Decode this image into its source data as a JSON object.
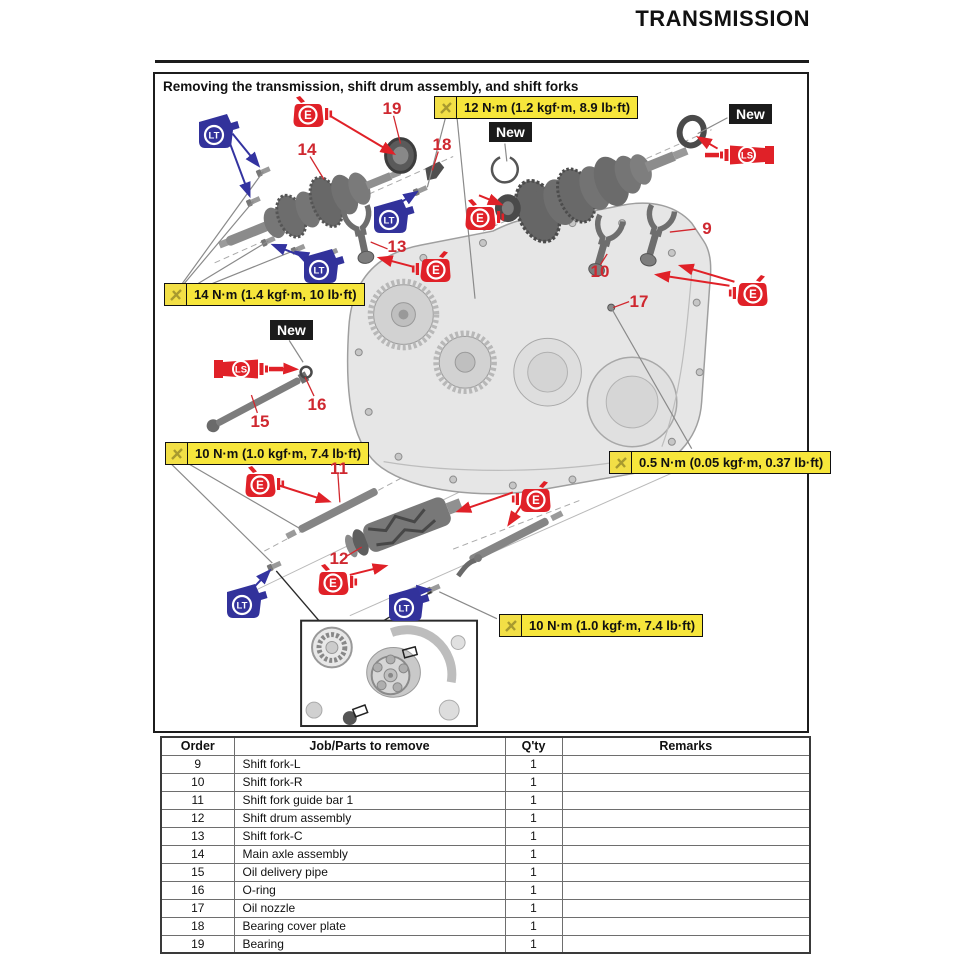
{
  "page": {
    "header_title": "TRANSMISSION"
  },
  "figure": {
    "title": "Removing the transmission, shift drum assembly, and shift forks",
    "new_label": "New",
    "callouts": [
      {
        "name": "torque-bearing-plate",
        "text": "12 N·m (1.2 kgf·m, 8.9 lb·ft)"
      },
      {
        "name": "torque-main-axle-bolts",
        "text": "14 N·m (1.4 kgf·m, 10 lb·ft)"
      },
      {
        "name": "torque-guide-bar",
        "text": "10 N·m (1.0 kgf·m, 7.4 lb·ft)"
      },
      {
        "name": "torque-oil-nozzle",
        "text": "0.5 N·m (0.05 kgf·m, 0.37 lb·ft)"
      },
      {
        "name": "torque-stopper-bolt",
        "text": "10 N·m (1.0 kgf·m, 7.4 lb·ft)"
      }
    ],
    "part_numbers": [
      "9",
      "10",
      "11",
      "12",
      "13",
      "14",
      "15",
      "16",
      "17",
      "18",
      "19"
    ],
    "icons": {
      "engine_oil": "E",
      "threadlocker": "LT",
      "grease": "LS"
    },
    "colors": {
      "red": "#e02128",
      "blue": "#32329b",
      "yellow": "#f7e63b"
    }
  },
  "table": {
    "headers": [
      "Order",
      "Job/Parts to remove",
      "Q'ty",
      "Remarks"
    ],
    "rows": [
      {
        "order": "9",
        "job": "Shift fork-L",
        "qty": "1",
        "remarks": ""
      },
      {
        "order": "10",
        "job": "Shift fork-R",
        "qty": "1",
        "remarks": ""
      },
      {
        "order": "11",
        "job": "Shift fork guide bar 1",
        "qty": "1",
        "remarks": ""
      },
      {
        "order": "12",
        "job": "Shift drum assembly",
        "qty": "1",
        "remarks": ""
      },
      {
        "order": "13",
        "job": "Shift fork-C",
        "qty": "1",
        "remarks": ""
      },
      {
        "order": "14",
        "job": "Main axle assembly",
        "qty": "1",
        "remarks": ""
      },
      {
        "order": "15",
        "job": "Oil delivery pipe",
        "qty": "1",
        "remarks": ""
      },
      {
        "order": "16",
        "job": "O-ring",
        "qty": "1",
        "remarks": ""
      },
      {
        "order": "17",
        "job": "Oil nozzle",
        "qty": "1",
        "remarks": ""
      },
      {
        "order": "18",
        "job": "Bearing cover plate",
        "qty": "1",
        "remarks": ""
      },
      {
        "order": "19",
        "job": "Bearing",
        "qty": "1",
        "remarks": ""
      }
    ]
  }
}
